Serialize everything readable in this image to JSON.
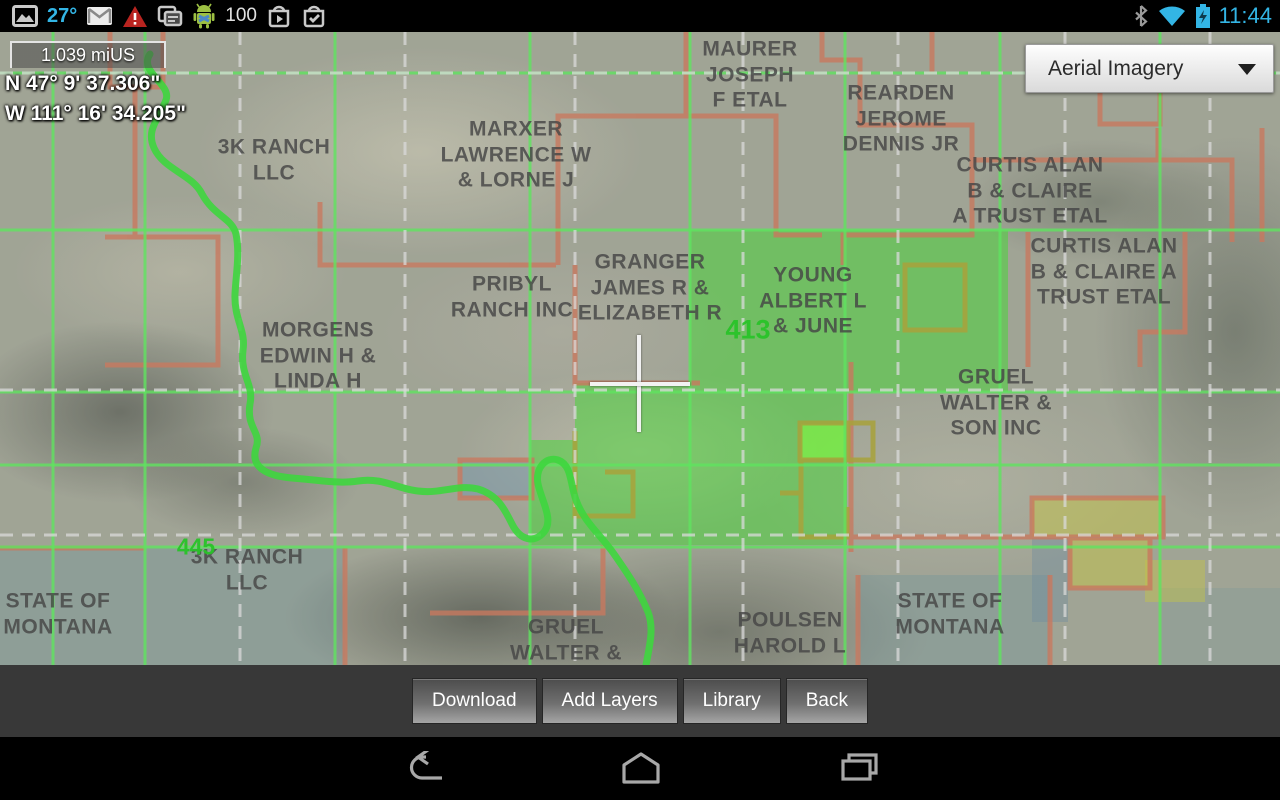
{
  "status_bar": {
    "temperature": "27°",
    "battery_percent": "100",
    "time": "11:44",
    "left_icon_names": [
      "gallery-icon",
      "gmail-icon",
      "warning-icon",
      "copy-icon",
      "android-icon",
      "play-store-icon",
      "checklist-icon"
    ],
    "right_icon_names": [
      "bluetooth-icon",
      "wifi-icon",
      "battery-charging-icon"
    ]
  },
  "map_overlay": {
    "scale_label": "1.039 miUS",
    "latitude": "N 47° 9' 37.306\"",
    "longitude": "W 111° 16' 34.205\""
  },
  "layer_selector": {
    "value": "Aerial Imagery"
  },
  "map": {
    "parcel_labels": [
      {
        "text": "MAURER\nJOSEPH\nF ETAL"
      },
      {
        "text": "REARDEN\nJEROME\nDENNIS JR"
      },
      {
        "text": "MARXER\nLAWRENCE W\n& LORNE J"
      },
      {
        "text": "3K RANCH\nLLC"
      },
      {
        "text": "CURTIS ALAN\nB & CLAIRE\nA TRUST ETAL"
      },
      {
        "text": "CURTIS ALAN\nB & CLAIRE A\nTRUST ETAL"
      },
      {
        "text": "PRIBYL\nRANCH INC"
      },
      {
        "text": "GRANGER\nJAMES R &\nELIZABETH R"
      },
      {
        "text": "YOUNG\nALBERT L\n& JUNE"
      },
      {
        "text": "MORGENS\nEDWIN H &\nLINDA H"
      },
      {
        "text": "GRUEL\nWALTER &\nSON INC"
      },
      {
        "text": "STATE OF\nMONTANA"
      },
      {
        "text": "3K RANCH\nLLC"
      },
      {
        "text": "GRUEL\nWALTER &"
      },
      {
        "text": "POULSEN\nHAROLD L"
      },
      {
        "text": "STATE OF\nMONTANA"
      }
    ],
    "section_numbers": [
      {
        "text": "413"
      },
      {
        "text": "445"
      }
    ]
  },
  "toolbar": {
    "buttons": [
      {
        "label": "Download"
      },
      {
        "label": "Add Layers"
      },
      {
        "label": "Library"
      },
      {
        "label": "Back"
      }
    ]
  },
  "nav_bar": {
    "icon_names": [
      "back-icon",
      "home-icon",
      "recents-icon"
    ]
  },
  "colors": {
    "holo_blue": "#33b5e5",
    "grid_green": "#54e054",
    "boundary_orange": "#c8795f",
    "highlight_green": "#3ddc2d",
    "section_number_green": "#28c328",
    "label_gray": "#464646"
  }
}
